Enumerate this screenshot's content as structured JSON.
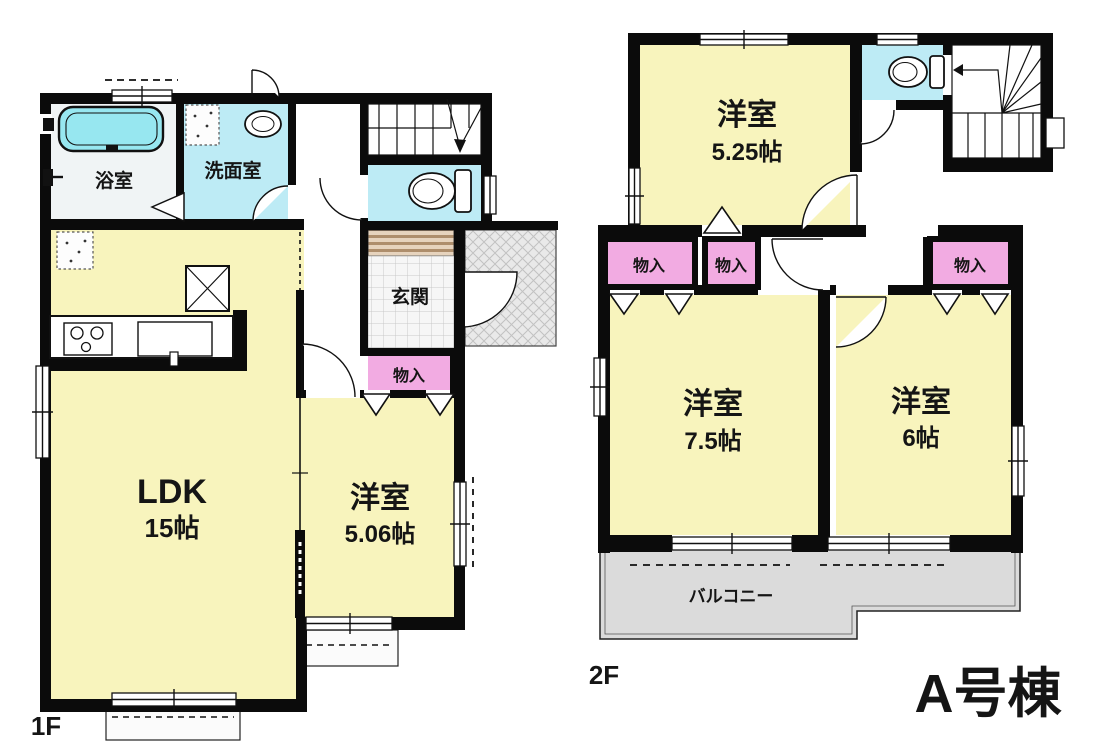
{
  "building": {
    "title": "A号棟"
  },
  "floor1": {
    "label": "1F",
    "bath": {
      "label": "浴室"
    },
    "washroom": {
      "label": "洗面室"
    },
    "entrance": {
      "label": "玄関"
    },
    "closet": {
      "label": "物入"
    },
    "ldk": {
      "label": "LDK",
      "size": "15帖"
    },
    "western_room": {
      "label": "洋室",
      "size": "5.06帖"
    }
  },
  "floor2": {
    "label": "2F",
    "room_525": {
      "label": "洋室",
      "size": "5.25帖"
    },
    "room_75": {
      "label": "洋室",
      "size": "7.5帖"
    },
    "room_6": {
      "label": "洋室",
      "size": "6帖"
    },
    "closet1": {
      "label": "物入"
    },
    "closet2": {
      "label": "物入"
    },
    "closet3": {
      "label": "物入"
    },
    "balcony": {
      "label": "バルコニー"
    }
  },
  "colors": {
    "room_yellow": "#F8F4BD",
    "wet_cyan": "#BDEBF5",
    "tub_cyan": "#97E7F0",
    "closet_pink": "#F2ABE2",
    "balcony_gray": "#DBDBDB",
    "porch_gray": "#E9E9E9",
    "bath_floor": "#F0F4F5",
    "wall_black": "#0B0B0B"
  }
}
